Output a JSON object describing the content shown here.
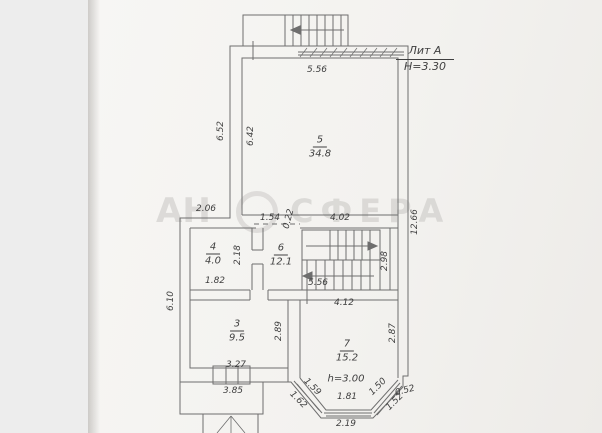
{
  "watermark": {
    "left": "АН",
    "right": "СФЕРА"
  },
  "legend": {
    "lit_label": "Лит А",
    "building_height": "H=3.30"
  },
  "rooms": [
    {
      "number": "5",
      "area": "34.8"
    },
    {
      "number": "4",
      "area": "4.0"
    },
    {
      "number": "6",
      "area": "12.1"
    },
    {
      "number": "3",
      "area": "9.5"
    },
    {
      "number": "7",
      "area": "15.2"
    }
  ],
  "annotations": {
    "room7_ceiling": "h=3.00"
  },
  "dimensions": {
    "top_window": "5.56",
    "upper_left_outer": "6.52",
    "upper_left_inner": "6.42",
    "right_side": "12.66",
    "left_step": "2.06",
    "opening_width": "1.54",
    "opening_offset": "0.22",
    "stair_hall_width": "4.02",
    "room4_depth": "2.18",
    "room4_width": "1.82",
    "stair_depth": "2.98",
    "lower_left_outer": "6.10",
    "hall_bottom": "5.56",
    "room7_top": "4.12",
    "room3_depth": "2.89",
    "room3_width": "3.27",
    "room3_outer": "3.85",
    "room7_depth": "2.87",
    "bay_left_inner": "1.59",
    "bay_left_outer": "1.62",
    "bay_right_inner": "1.50",
    "bay_right_outer": "1.52",
    "bay_bottom_inner": "1.81",
    "bay_right_step": "0.52",
    "bay_bottom_outer": "2.19"
  },
  "colors": {
    "paper": "#f3f2ef",
    "background": "#ededed",
    "ink": "#6e6e6e",
    "text_ink": "#3f3f3f",
    "watermark": "#c8c6c3"
  }
}
